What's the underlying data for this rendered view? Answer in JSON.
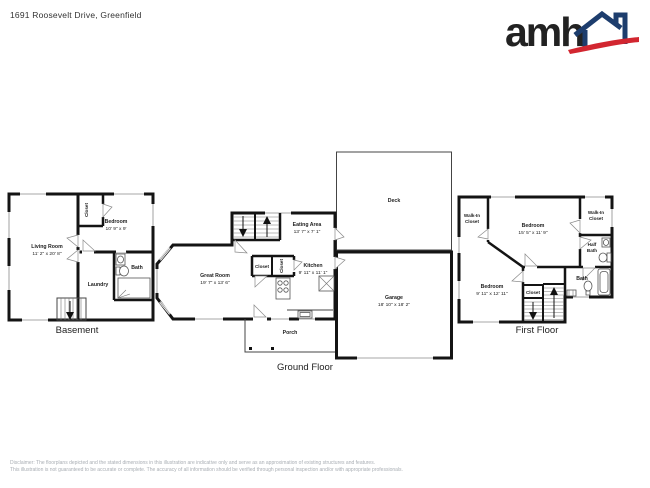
{
  "header": {
    "address": "1691 Roosevelt Drive, Greenfield",
    "logo": {
      "text": "amh",
      "navy": "#1d3d6d",
      "red": "#d22630"
    }
  },
  "floors": {
    "basement": {
      "label": "Basement",
      "rooms": {
        "living_room": {
          "name": "Living Room",
          "dims": "11' 2\" x 20' 8\""
        },
        "bedroom": {
          "name": "Bedroom",
          "dims": "10' 9\" x 9'"
        },
        "closet": {
          "name": "Closet"
        },
        "laundry": {
          "name": "Laundry"
        },
        "bath": {
          "name": "Bath"
        }
      }
    },
    "ground": {
      "label": "Ground Floor",
      "rooms": {
        "great_room": {
          "name": "Great Room",
          "dims": "19' 7\" x 13' 6\""
        },
        "eating_area": {
          "name": "Eating Area",
          "dims": "13' 7\" x 7' 1\""
        },
        "kitchen": {
          "name": "Kitchen",
          "dims": "9' 11\" x 11' 1\""
        },
        "closet_a": {
          "name": "Closet"
        },
        "closet_b": {
          "name": "Closet"
        },
        "deck": {
          "name": "Deck"
        },
        "garage": {
          "name": "Garage",
          "dims": "18' 10\" x 18' 2\""
        },
        "porch": {
          "name": "Porch"
        }
      }
    },
    "first": {
      "label": "First Floor",
      "rooms": {
        "bedroom_1": {
          "name": "Bedroom",
          "dims": "15' 5\" x 11' 9\""
        },
        "bedroom_2": {
          "name": "Bedroom",
          "dims": "9' 11\" x 12' 11\""
        },
        "walk_in_closet_left": {
          "name": "Walk-In Closet"
        },
        "walk_in_closet_right": {
          "name": "Walk-In Closet"
        },
        "half_bath": {
          "name": "Half Bath"
        },
        "bath": {
          "name": "Bath"
        },
        "closet": {
          "name": "Closet"
        }
      }
    }
  },
  "footer": {
    "disclaimer_line1": "Disclaimer: The floorplans depicted and the stated dimensions in this illustration are indicative only and serve as an approximation of existing structures and features.",
    "disclaimer_line2": "This illustration is not guaranteed to be accurate or complete. The accuracy of all information should be verified through personal inspection and/or with appropriate professionals."
  }
}
